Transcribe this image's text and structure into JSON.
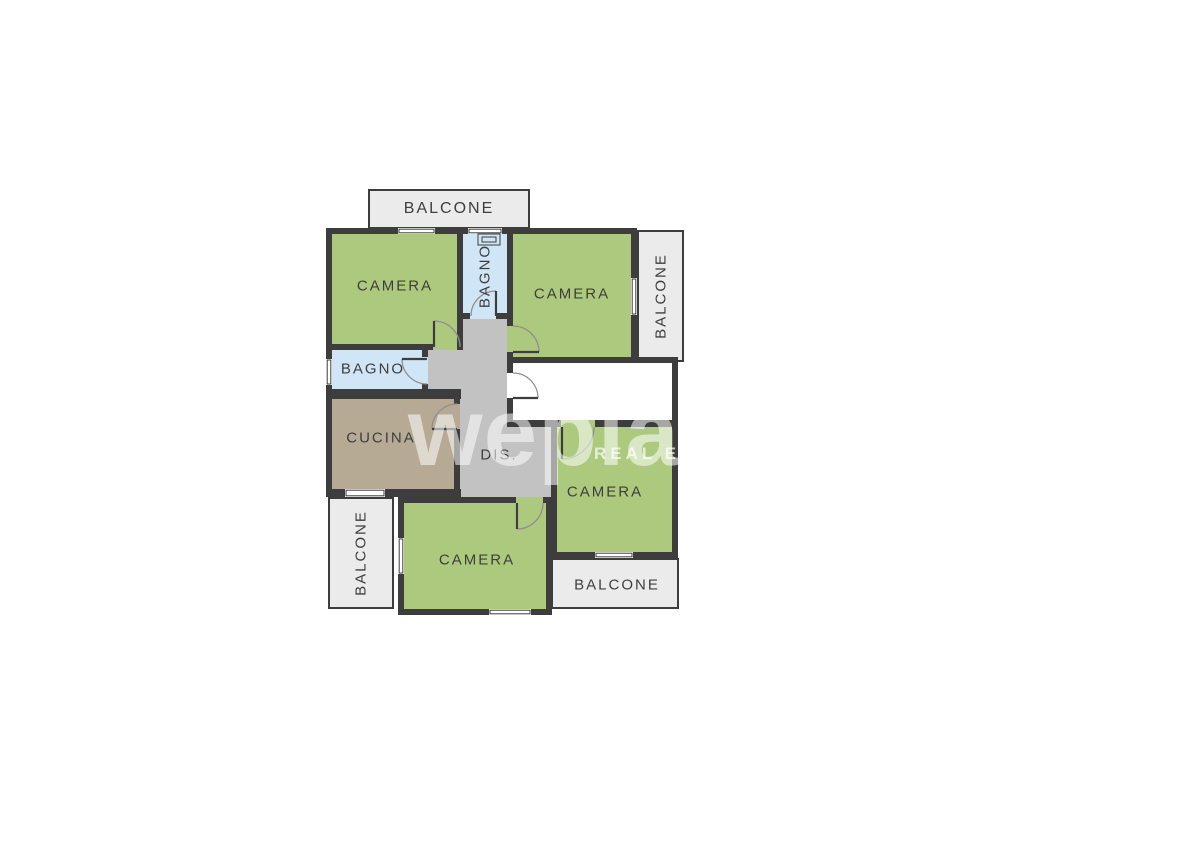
{
  "watermark": {
    "brand": "weplaza",
    "tagline": "REAL ESTATE"
  },
  "colors": {
    "wall": "#3d3d3d",
    "bedroom_green": "#adc97e",
    "bathroom_blue": "#d0e6f6",
    "kitchen_taupe": "#b7aa95",
    "corridor_gray": "#c2c2c2",
    "balcony_gray": "#ebebeb",
    "door_arc": "#8f8f8f",
    "label_text": "#3e3e3e"
  },
  "rooms": {
    "balcony_top": {
      "label": "BALCONE"
    },
    "bedroom_top_left": {
      "label": "CAMERA"
    },
    "bathroom_top": {
      "label": "BAGNO"
    },
    "bedroom_top_right": {
      "label": "CAMERA"
    },
    "balcony_right": {
      "label": "BALCONE"
    },
    "bathroom_left": {
      "label": "BAGNO"
    },
    "kitchen": {
      "label": "CUCINA"
    },
    "corridor": {
      "label": "DIS."
    },
    "bedroom_right": {
      "label": "CAMERA"
    },
    "balcony_bottom_left": {
      "label": "BALCONE"
    },
    "bedroom_bottom": {
      "label": "CAMERA"
    },
    "balcony_bottom_right": {
      "label": "BALCONE"
    }
  }
}
